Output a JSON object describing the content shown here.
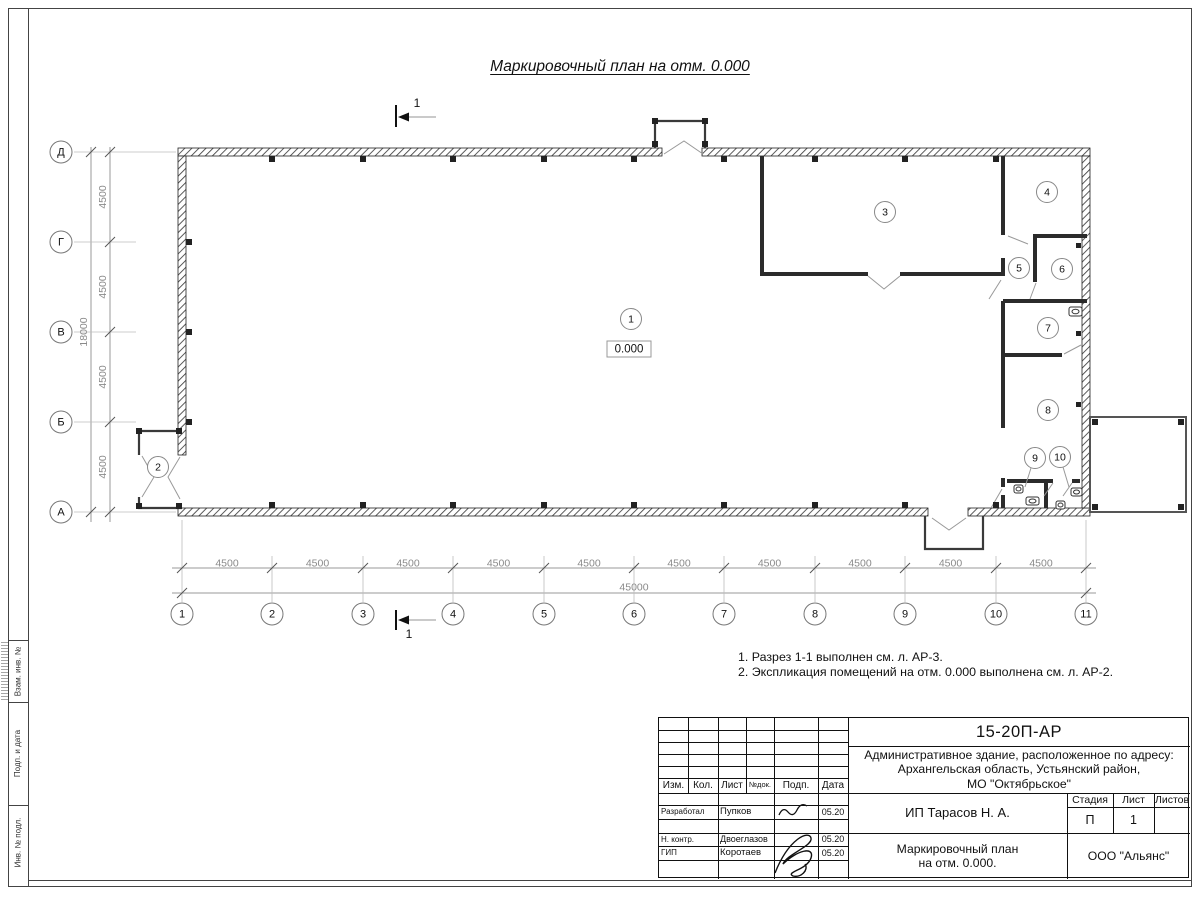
{
  "page": {
    "sheet_title": "Маркировочный план на отм. 0.000",
    "notes": [
      "1. Разрез 1-1 выполнен см. л. АР-3.",
      "2. Экспликация помещений на отм. 0.000 выполнена см. л. АР-2."
    ]
  },
  "plan": {
    "elevation": "0.000",
    "section_label": "1",
    "axes_bottom": [
      "1",
      "2",
      "3",
      "4",
      "5",
      "6",
      "7",
      "8",
      "9",
      "10",
      "11"
    ],
    "axes_left": [
      "Д",
      "Г",
      "В",
      "Б",
      "А"
    ],
    "dim_bay_h": "4500",
    "dim_total_h": "45000",
    "dim_bay_v": "4500",
    "dim_total_v": "18000",
    "rooms": [
      "1",
      "2",
      "3",
      "4",
      "5",
      "6",
      "7",
      "8",
      "9",
      "10"
    ]
  },
  "frame": {
    "side_labels": [
      "Взам. инв. №",
      "Подп. и дата",
      "Инв. № подл."
    ]
  },
  "title_block": {
    "doc_number": "15-20П-АР",
    "project_lines": [
      "Административное здание, расположенное по адресу:",
      "Архангельская область, Устьянский район,",
      "МО \"Октябрьское\""
    ],
    "header_cols": [
      "Изм.",
      "Кол.",
      "Лист",
      "№док.",
      "Подп.",
      "Дата"
    ],
    "rows": [
      {
        "role": "Разработал",
        "name": "Пупков",
        "date": "05.20"
      },
      {
        "role": "Н. контр.",
        "name": "Двоеглазов",
        "date": "05.20"
      },
      {
        "role": "ГИП",
        "name": "Коротаев",
        "date": "05.20"
      }
    ],
    "client": "ИП Тарасов Н. А.",
    "sheet_name_lines": [
      "Маркировочный план",
      "на отм. 0.000."
    ],
    "stage_label": "Стадия",
    "list_label": "Лист",
    "listov_label": "Листов",
    "stage_value": "П",
    "list_value": "1",
    "company": "ООО \"Альянс\""
  }
}
